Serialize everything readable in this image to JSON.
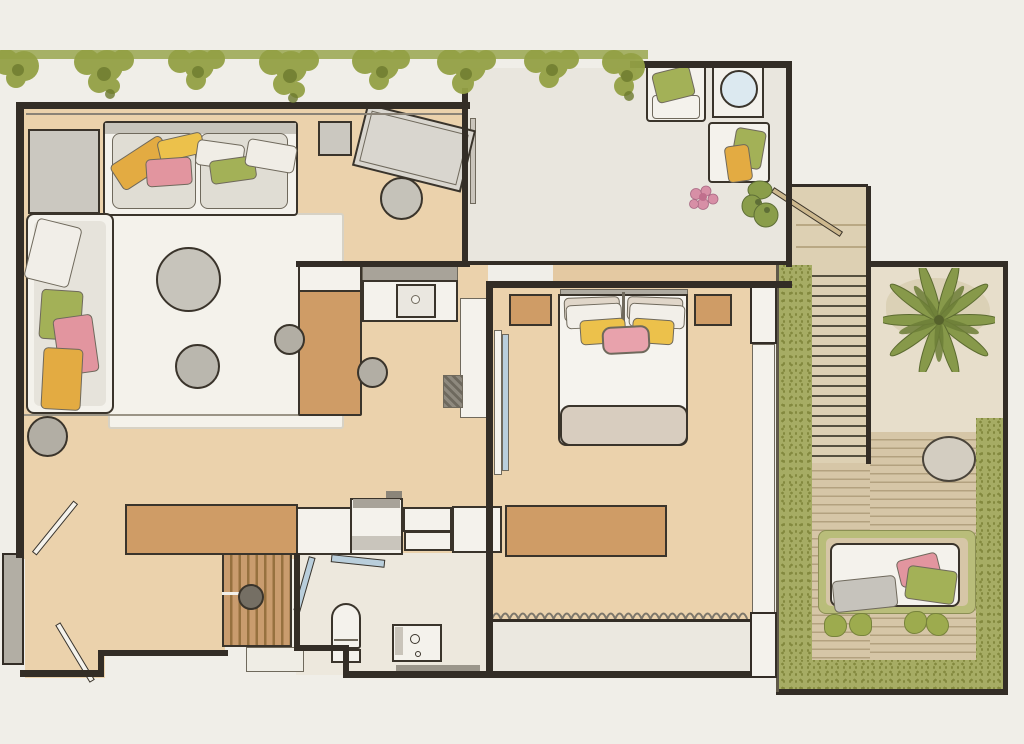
{
  "meta": {
    "type": "floor-plan-illustration",
    "style": "hand-drawn watercolor apartment plan with roof terrace, staircase and garden",
    "canvas_px": {
      "width": 1024,
      "height": 744
    },
    "visible_text": "none"
  },
  "palette": {
    "bg": "#f0eee8",
    "ink": "#3a342b",
    "ink_soft": "#6f695c",
    "wall": "#332d26",
    "floor_tan": "#ebd2ac",
    "floor_tan_deep": "#e4c9a2",
    "terrace": "#e9e6de",
    "bath_floor": "#ede8dd",
    "balcony": "#ebe8e0",
    "rug": "#f4f2eb",
    "furn_white": "#f4f2ec",
    "furn_cream": "#e0ddd4",
    "furn_gray": "#c7c4bb",
    "furn_gray_dark": "#b2aea4",
    "wood": "#cf9c66",
    "slat_light": "#c99c6e",
    "slat_dark": "#96713f",
    "pillow_yellow": "#e3ab42",
    "pillow_yellow2": "#ecc14b",
    "pillow_pink": "#e2959f",
    "pillow_green": "#a3b157",
    "hedge": "#a6ac64",
    "hedge_dark": "#83893f",
    "foliage": "#94a145",
    "foliage_dark": "#6d7a2e",
    "deck": "#d6c6a7",
    "deck_line": "#b3a17f",
    "stair": "#ddd0b3",
    "stair_line": "#55503f",
    "gravel": "#e7decb",
    "glass": "#b9cedb",
    "stone": "#d3cdc1",
    "blanket": "#d8cdbf",
    "beige_pillow": "#e0d6c9",
    "headboard": "#b0aca2",
    "backsplash": "#a8a399",
    "metal_gray": "#9b968b",
    "grass": "#b9bd7a",
    "handrail": "#cdb88e"
  },
  "scene": {
    "rooms": [
      {
        "id": "living-room",
        "floor": "tan watercolor wash",
        "contents": [
          "wall-cabinet",
          "two-seat-sofa",
          "sofa-pillows: yellow, yellow, pink, green, white x2",
          "daybed along left wall",
          "daybed-pillows: white, green, pink, yellow",
          "large-area-rug",
          "round-coffee-table-large",
          "round-coffee-table-small",
          "floor-pouf",
          "angled-desk",
          "round-desk-chair",
          "square-side-stool"
        ]
      },
      {
        "id": "kitchen",
        "contents": [
          "white-counter-L",
          "sink-with-faucet",
          "gray-backsplash",
          "wood-island-table",
          "round-stool x2",
          "appliance-hatched",
          "partition-column"
        ]
      },
      {
        "id": "bedroom",
        "contents": [
          "double-bed",
          "gray-headboard",
          "nightstand x2 (wood)",
          "bed-pillows: beige x2, white x2, yellow x2, pink center",
          "foot-blanket",
          "leaning-mirror-panel",
          "wood-dresser",
          "wavy-window-curtain",
          "sliding-glass-wall to garden"
        ]
      },
      {
        "id": "bathroom",
        "contents": [
          "wood-slat-shower-floor",
          "shower-drain",
          "glass-door x2",
          "toilet",
          "vanity-with-sink",
          "shower-bench",
          "white-cabinet-row"
        ]
      },
      {
        "id": "entry-hall",
        "contents": [
          "double-entry-doors (two swinging leaves)",
          "wood-wardrobe"
        ]
      },
      {
        "id": "roof-terrace",
        "contents": [
          "armchair-with-green-cushion",
          "armchair-with-green-and-yellow-cushions",
          "round-side-table",
          "pink-flowering-plant",
          "green-plant",
          "hanging-foliage-border along top"
        ]
      },
      {
        "id": "staircase",
        "contents": [
          "upper-landing (wood)",
          "straight-stair-run (~20 treads)",
          "diagonal-handrail"
        ]
      },
      {
        "id": "garden",
        "contents": [
          "gravel-patio",
          "palm-tree",
          "plank-wood-deck",
          "round-boulder",
          "hedge-border left/right/bottom",
          "lounge-daybed with gray pillow, pink cushion, green cushion",
          "grass-edged-platform",
          "shrub x4"
        ]
      }
    ]
  }
}
